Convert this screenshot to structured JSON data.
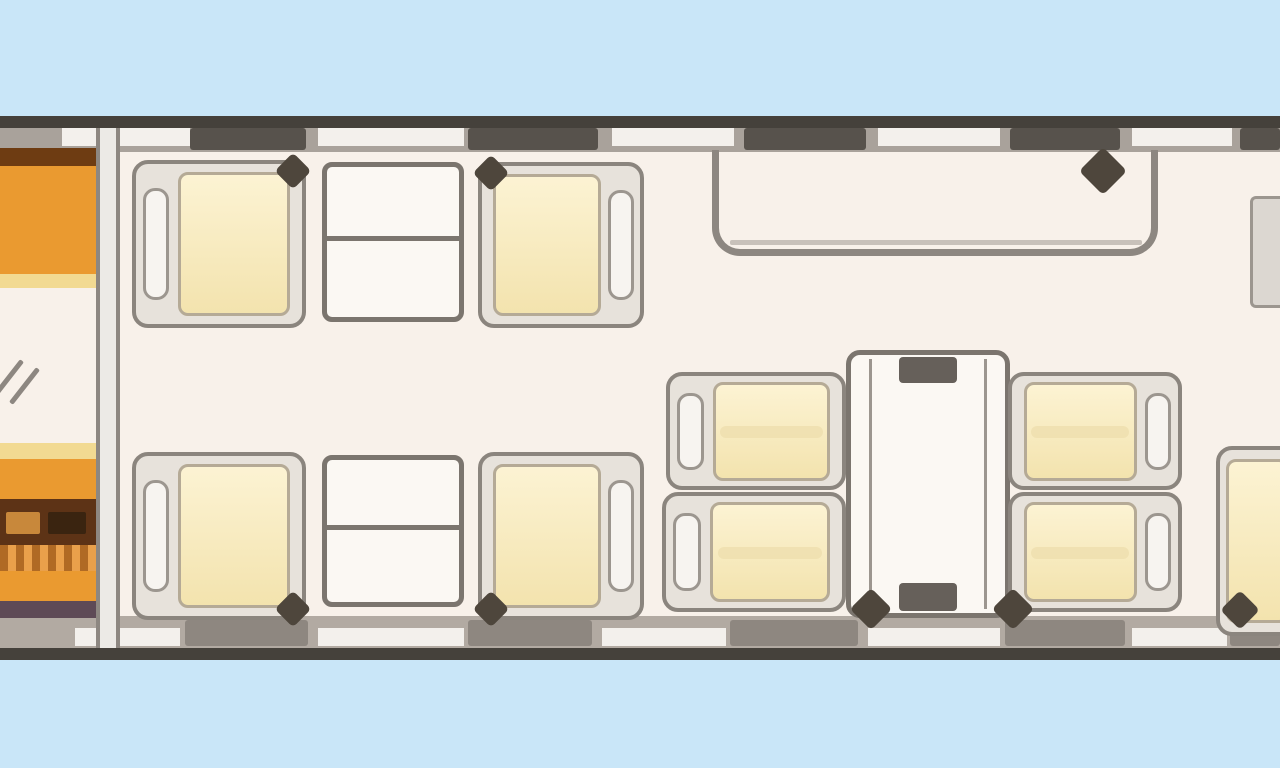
{
  "scene": "aircraft-cabin-floorplan-top-view",
  "colors": {
    "sky": "#c9e6f8",
    "hullDark": "#45413b",
    "wallGray": "#a9a29b",
    "wallGrayBottom": "#b2aaa2",
    "windowDark": "#57524c",
    "windowDarkBottom": "#8e8780",
    "windowLight": "#f3f0ec",
    "floor": "#f8f1ea",
    "lineGray": "#8d8781",
    "frameBg": "#e7e2db",
    "frameLine": "#8b857e",
    "pillBg": "#f7f4f0",
    "pillLine": "#9c968f",
    "cushionHi": "#fcf3d3",
    "cushionLo": "#f3e3ae",
    "cushionSeam": "#eddfae",
    "cushionLine": "#b5aa96",
    "tableBg": "#fbf8f3",
    "tableLine": "#7b756e",
    "tabDark": "#66605a",
    "wedge": "#4e463c",
    "orange": "#ea9a30",
    "brownDark": "#6e3c12",
    "paleStrip": "#f2da92",
    "unitDark": "#5d3316",
    "drawerLight": "#c8883b",
    "drawerDark": "#3a2410",
    "purple": "#5e4a56",
    "partitionBg": "#eceae6",
    "cabinetPartial": "#dcd7d1"
  },
  "elements": [
    {
      "type": "rect",
      "name": "sky-background",
      "x": 0,
      "y": 0,
      "w": 1280,
      "h": 768,
      "css": {
        "background": "$sky"
      }
    },
    {
      "type": "rect",
      "name": "fuselage-top-outline",
      "x": 0,
      "y": 116,
      "w": 1280,
      "h": 12,
      "css": {
        "background": "$hullDark"
      }
    },
    {
      "type": "rect",
      "name": "fuselage-top-wall",
      "x": 0,
      "y": 128,
      "w": 1280,
      "h": 24,
      "css": {
        "background": "$wallGray"
      }
    },
    {
      "type": "rect",
      "name": "cabin-floor",
      "x": 0,
      "y": 152,
      "w": 1280,
      "h": 466,
      "css": {
        "background": "$floor"
      }
    },
    {
      "type": "rect",
      "name": "fuselage-bottom-wall",
      "x": 0,
      "y": 616,
      "w": 1280,
      "h": 32,
      "css": {
        "background": "$wallGrayBottom"
      }
    },
    {
      "type": "rect",
      "name": "fuselage-bottom-outline",
      "x": 0,
      "y": 648,
      "w": 1280,
      "h": 12,
      "css": {
        "background": "$hullDark"
      }
    },
    {
      "type": "rect",
      "name": "top-wall-gap",
      "x": 62,
      "y": 128,
      "w": 128,
      "h": 18,
      "css": {
        "background": "$windowLight"
      }
    },
    {
      "type": "rect",
      "name": "top-wall-gap",
      "x": 318,
      "y": 128,
      "w": 146,
      "h": 18,
      "css": {
        "background": "$windowLight"
      }
    },
    {
      "type": "rect",
      "name": "top-wall-gap",
      "x": 612,
      "y": 128,
      "w": 122,
      "h": 18,
      "css": {
        "background": "$windowLight"
      }
    },
    {
      "type": "rect",
      "name": "top-wall-gap",
      "x": 878,
      "y": 128,
      "w": 122,
      "h": 18,
      "css": {
        "background": "$windowLight"
      }
    },
    {
      "type": "rect",
      "name": "top-wall-gap",
      "x": 1132,
      "y": 128,
      "w": 100,
      "h": 18,
      "css": {
        "background": "$windowLight"
      }
    },
    {
      "type": "rect",
      "name": "cabin-window",
      "x": 190,
      "y": 128,
      "w": 116,
      "h": 22,
      "css": {
        "background": "$windowDark",
        "borderRadius": "3px"
      }
    },
    {
      "type": "rect",
      "name": "cabin-window",
      "x": 468,
      "y": 128,
      "w": 130,
      "h": 22,
      "css": {
        "background": "$windowDark",
        "borderRadius": "3px"
      }
    },
    {
      "type": "rect",
      "name": "cabin-window",
      "x": 744,
      "y": 128,
      "w": 122,
      "h": 22,
      "css": {
        "background": "$windowDark",
        "borderRadius": "3px"
      }
    },
    {
      "type": "rect",
      "name": "cabin-window",
      "x": 1010,
      "y": 128,
      "w": 110,
      "h": 22,
      "css": {
        "background": "$windowDark",
        "borderRadius": "3px"
      }
    },
    {
      "type": "rect",
      "name": "cabin-window",
      "x": 1240,
      "y": 128,
      "w": 40,
      "h": 22,
      "css": {
        "background": "$windowDark",
        "borderRadius": "3px"
      }
    },
    {
      "type": "rect",
      "name": "bottom-wall-gap",
      "x": 75,
      "y": 628,
      "w": 105,
      "h": 18,
      "css": {
        "background": "$windowLight"
      }
    },
    {
      "type": "rect",
      "name": "bottom-wall-gap",
      "x": 318,
      "y": 628,
      "w": 146,
      "h": 18,
      "css": {
        "background": "$windowLight"
      }
    },
    {
      "type": "rect",
      "name": "bottom-wall-gap",
      "x": 602,
      "y": 628,
      "w": 124,
      "h": 18,
      "css": {
        "background": "$windowLight"
      }
    },
    {
      "type": "rect",
      "name": "bottom-wall-gap",
      "x": 868,
      "y": 628,
      "w": 132,
      "h": 18,
      "css": {
        "background": "$windowLight"
      }
    },
    {
      "type": "rect",
      "name": "bottom-wall-gap",
      "x": 1132,
      "y": 628,
      "w": 95,
      "h": 18,
      "css": {
        "background": "$windowLight"
      }
    },
    {
      "type": "rect",
      "name": "cabin-window",
      "x": 185,
      "y": 620,
      "w": 123,
      "h": 26,
      "css": {
        "background": "$windowDarkBottom",
        "borderRadius": "3px"
      }
    },
    {
      "type": "rect",
      "name": "cabin-window",
      "x": 468,
      "y": 620,
      "w": 124,
      "h": 26,
      "css": {
        "background": "$windowDarkBottom",
        "borderRadius": "3px"
      }
    },
    {
      "type": "rect",
      "name": "cabin-window",
      "x": 730,
      "y": 620,
      "w": 128,
      "h": 26,
      "css": {
        "background": "$windowDarkBottom",
        "borderRadius": "3px"
      }
    },
    {
      "type": "rect",
      "name": "cabin-window",
      "x": 1005,
      "y": 620,
      "w": 120,
      "h": 26,
      "css": {
        "background": "$windowDarkBottom",
        "borderRadius": "3px"
      }
    },
    {
      "type": "rect",
      "name": "cabin-window",
      "x": 1230,
      "y": 620,
      "w": 50,
      "h": 26,
      "css": {
        "background": "$windowDarkBottom",
        "borderRadius": "3px"
      }
    },
    {
      "type": "rect",
      "name": "galley-bulkhead-partition",
      "x": 96,
      "y": 128,
      "w": 24,
      "h": 520,
      "css": {
        "background": "$partitionBg",
        "borderLeft": "4px solid $lineGray",
        "borderRight": "4px solid $lineGray"
      }
    },
    {
      "type": "rect",
      "name": "galley-top-counter-edge",
      "x": 0,
      "y": 148,
      "w": 96,
      "h": 18,
      "css": {
        "background": "$brownDark"
      }
    },
    {
      "type": "rect",
      "name": "galley-top-cabinet",
      "x": 0,
      "y": 166,
      "w": 96,
      "h": 108,
      "css": {
        "background": "$orange"
      }
    },
    {
      "type": "rect",
      "name": "galley-top-shelf-strip",
      "x": 0,
      "y": 274,
      "w": 96,
      "h": 14,
      "css": {
        "background": "$paleStrip"
      }
    },
    {
      "type": "rect",
      "name": "galley-lower-shelf-strip",
      "x": 0,
      "y": 443,
      "w": 96,
      "h": 16,
      "css": {
        "background": "$paleStrip"
      }
    },
    {
      "type": "rect",
      "name": "galley-lower-cabinet",
      "x": 0,
      "y": 459,
      "w": 96,
      "h": 40,
      "css": {
        "background": "$orange"
      }
    },
    {
      "type": "rect",
      "name": "galley-equipment-unit",
      "x": 0,
      "y": 499,
      "w": 96,
      "h": 46,
      "css": {
        "background": "$unitDark"
      }
    },
    {
      "type": "rect",
      "name": "galley-drawer",
      "x": 6,
      "y": 512,
      "w": 34,
      "h": 22,
      "css": {
        "background": "$drawerLight",
        "borderRadius": "2px"
      }
    },
    {
      "type": "rect",
      "name": "galley-drawer",
      "x": 48,
      "y": 512,
      "w": 38,
      "h": 22,
      "css": {
        "background": "$drawerDark",
        "borderRadius": "2px"
      }
    },
    {
      "type": "rect",
      "name": "galley-wood-slats",
      "x": 0,
      "y": 545,
      "w": 96,
      "h": 26,
      "css": {
        "background": "repeating-linear-gradient(90deg,#b06a24 0 8px,#e9a04b 8px 16px)"
      }
    },
    {
      "type": "rect",
      "name": "galley-lower-cabinet-2",
      "x": 0,
      "y": 571,
      "w": 96,
      "h": 30,
      "css": {
        "background": "$orange"
      }
    },
    {
      "type": "rect",
      "name": "galley-base-strip",
      "x": 0,
      "y": 601,
      "w": 96,
      "h": 17,
      "css": {
        "background": "$purple"
      }
    },
    {
      "type": "rect",
      "name": "entry-door-swing-mark",
      "x": 6,
      "y": 356,
      "w": 5,
      "h": 44,
      "css": {
        "background": "$lineGray",
        "transform": "rotate(38deg)",
        "borderRadius": "2px"
      }
    },
    {
      "type": "rect",
      "name": "entry-door-swing-mark",
      "x": 22,
      "y": 364,
      "w": 5,
      "h": 44,
      "css": {
        "background": "$lineGray",
        "transform": "rotate(38deg)",
        "borderRadius": "2px"
      }
    },
    {
      "type": "divan",
      "name": "divan-outline",
      "x": 712,
      "y": 150,
      "w": 446,
      "h": 106
    },
    {
      "type": "rect",
      "name": "divan-inner-line",
      "x": 730,
      "y": 240,
      "w": 412,
      "h": 5,
      "css": {
        "background": "$lineGray",
        "opacity": "0.45",
        "borderRadius": "2px"
      }
    },
    {
      "type": "seat",
      "name": "club-seat-forward-left-top",
      "x": 132,
      "y": 160,
      "w": 174,
      "h": 168,
      "facing": "right",
      "wedges": [
        "tr"
      ]
    },
    {
      "type": "table",
      "name": "club-table-top",
      "x": 322,
      "y": 162,
      "w": 142,
      "h": 160,
      "divider": "h"
    },
    {
      "type": "seat",
      "name": "club-seat-forward-right-top",
      "x": 478,
      "y": 162,
      "w": 166,
      "h": 166,
      "facing": "left",
      "wedges": [
        "tl"
      ]
    },
    {
      "type": "seat",
      "name": "club-seat-forward-left-bottom",
      "x": 132,
      "y": 452,
      "w": 174,
      "h": 168,
      "facing": "right",
      "wedges": [
        "br"
      ]
    },
    {
      "type": "table",
      "name": "club-table-bottom",
      "x": 322,
      "y": 455,
      "w": 142,
      "h": 152,
      "divider": "h"
    },
    {
      "type": "seat",
      "name": "club-seat-forward-right-bottom",
      "x": 478,
      "y": 452,
      "w": 166,
      "h": 168,
      "facing": "left",
      "wedges": [
        "bl"
      ]
    },
    {
      "type": "seat",
      "name": "conference-seat-left-upper",
      "x": 666,
      "y": 372,
      "w": 180,
      "h": 118,
      "facing": "right",
      "seam": "h",
      "wedges": []
    },
    {
      "type": "seat",
      "name": "conference-seat-left-lower",
      "x": 662,
      "y": 492,
      "w": 184,
      "h": 120,
      "facing": "right",
      "seam": "h",
      "wedges": []
    },
    {
      "type": "conftable",
      "name": "conference-table",
      "x": 846,
      "y": 350,
      "w": 164,
      "h": 268
    },
    {
      "type": "seat",
      "name": "conference-seat-right-upper",
      "x": 1008,
      "y": 372,
      "w": 174,
      "h": 118,
      "facing": "left",
      "seam": "h",
      "wedges": []
    },
    {
      "type": "seat",
      "name": "conference-seat-right-lower",
      "x": 1008,
      "y": 492,
      "w": 174,
      "h": 120,
      "facing": "left",
      "seam": "h",
      "wedges": []
    },
    {
      "type": "rect",
      "name": "aft-cabinet-partial",
      "x": 1250,
      "y": 196,
      "w": 30,
      "h": 112,
      "css": {
        "background": "$cabinetPartial",
        "border": "3px solid $pillLine",
        "borderRight": "none",
        "borderRadius": "6px 0 0 6px"
      }
    },
    {
      "type": "seat",
      "name": "aft-seat-partial-right",
      "x": 1216,
      "y": 446,
      "w": 100,
      "h": 190,
      "facing": "left",
      "wedges": []
    },
    {
      "type": "wedge",
      "name": "shadow-wedge",
      "x": 1086,
      "y": 154,
      "w": 34,
      "h": 34
    },
    {
      "type": "wedge",
      "name": "shadow-wedge",
      "x": 856,
      "y": 594,
      "w": 30,
      "h": 30
    },
    {
      "type": "wedge",
      "name": "shadow-wedge",
      "x": 998,
      "y": 594,
      "w": 30,
      "h": 30
    },
    {
      "type": "wedge",
      "name": "shadow-wedge",
      "x": 1226,
      "y": 596,
      "w": 28,
      "h": 28
    }
  ]
}
